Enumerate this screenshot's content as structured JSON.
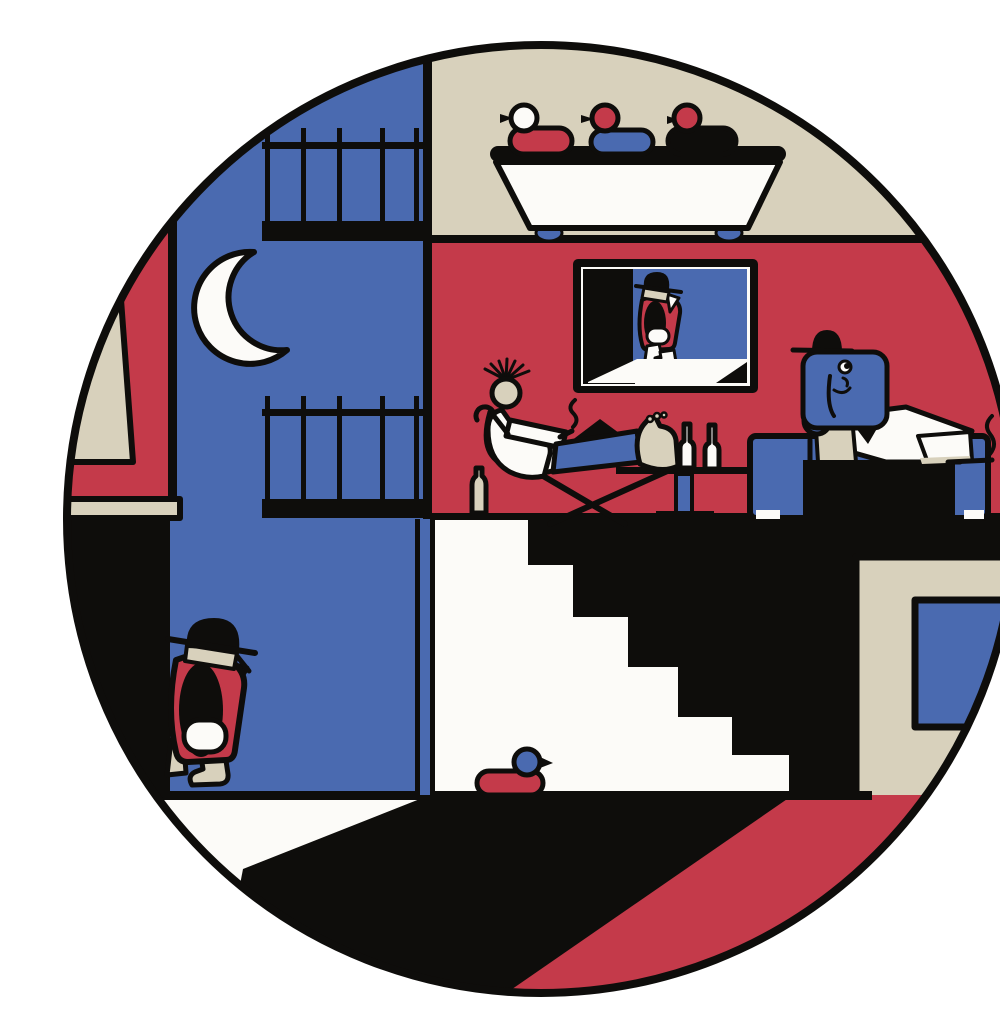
{
  "scene": {
    "title": "Circular flat-style illustration: night-time cross-section of a house",
    "description": "A circular vignette shows a building cut open at night: rubber ducks on a bathtub upstairs, a punk lounging in a deck chair with bottles, an elephant in a shirt smoking at a desk, a TV showing a walking figure, a crescent moon over balconies, a walking figure in the street and a toy duck by a staircase.",
    "palette": {
      "red": "#c43a4a",
      "blue": "#4a6ab0",
      "beige": "#d8d1bc",
      "ink": "#0e0d0b",
      "paper": "#fcfbf8",
      "page": "#ffffff"
    },
    "elements": [
      "crescent-moon",
      "balcony-railing-upper",
      "balcony-railing-lower",
      "bathtub",
      "rubber-duck-white-red",
      "rubber-duck-red-blue",
      "rubber-duck-red-black",
      "tv-with-walking-figure",
      "reclining-punk-in-deck-chair",
      "cane",
      "cigarette-smoke",
      "wine-bottles",
      "side-table",
      "elephant-at-desk",
      "blue-sofa",
      "paper-document",
      "staircase",
      "toy-duck-on-floor",
      "street-walking-figure",
      "ledge",
      "window-lower-right"
    ]
  }
}
